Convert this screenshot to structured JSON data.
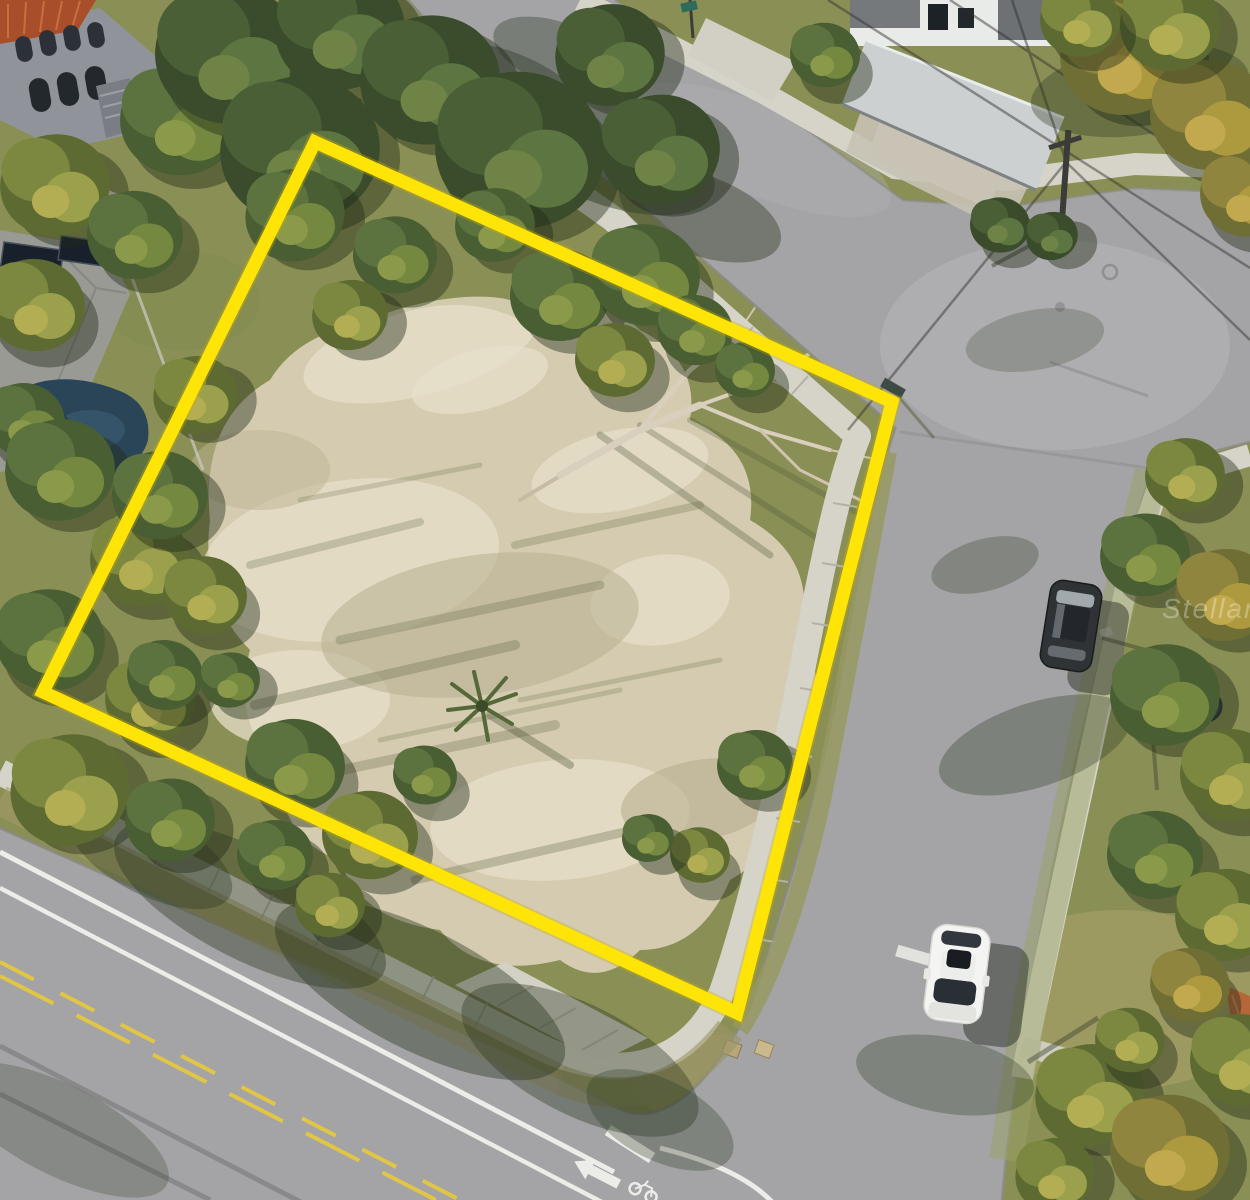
{
  "watermark": {
    "text": "StellarMLS"
  },
  "colors": {
    "boundary": "#ffe408",
    "boundary_edge": "#c9af00",
    "asphalt": "#a4a4a6",
    "sidewalk": "#d6d4c8",
    "sand": "#d5cbb0",
    "sand_light": "#e6dfca",
    "grass": "#8a8f55",
    "lane_yellow": "#e7c93e",
    "lane_white": "#f2f2ef",
    "roof_red": "#a84e2a",
    "roof_orange": "#b5673a",
    "pool_blue": "#2a4557",
    "white_car": "#f4f4f2",
    "dark_car": "#2f3336"
  },
  "scene": {
    "type": "aerial-drone-photo",
    "subject": "vacant corner lot outlined in yellow at a street intersection",
    "boundary": {
      "label": "property-boundary-outline",
      "points": "315,142 892,402 737,1013 43,692"
    },
    "vehicles": [
      {
        "label": "white-car-on-side-street"
      },
      {
        "label": "dark-car-parked-on-side-street"
      }
    ],
    "road_markings": [
      {
        "label": "double-yellow-center-line"
      },
      {
        "label": "white-lane-lines"
      },
      {
        "label": "bike-lane-arrow"
      },
      {
        "label": "bicycle-symbol"
      },
      {
        "label": "stop-bar"
      }
    ],
    "structures": [
      {
        "label": "mediterranean-building-with-arches"
      },
      {
        "label": "house-with-solar-panels"
      },
      {
        "label": "swimming-pool"
      },
      {
        "label": "modern-house-with-carport"
      },
      {
        "label": "tile-roof-house-corner"
      }
    ]
  }
}
